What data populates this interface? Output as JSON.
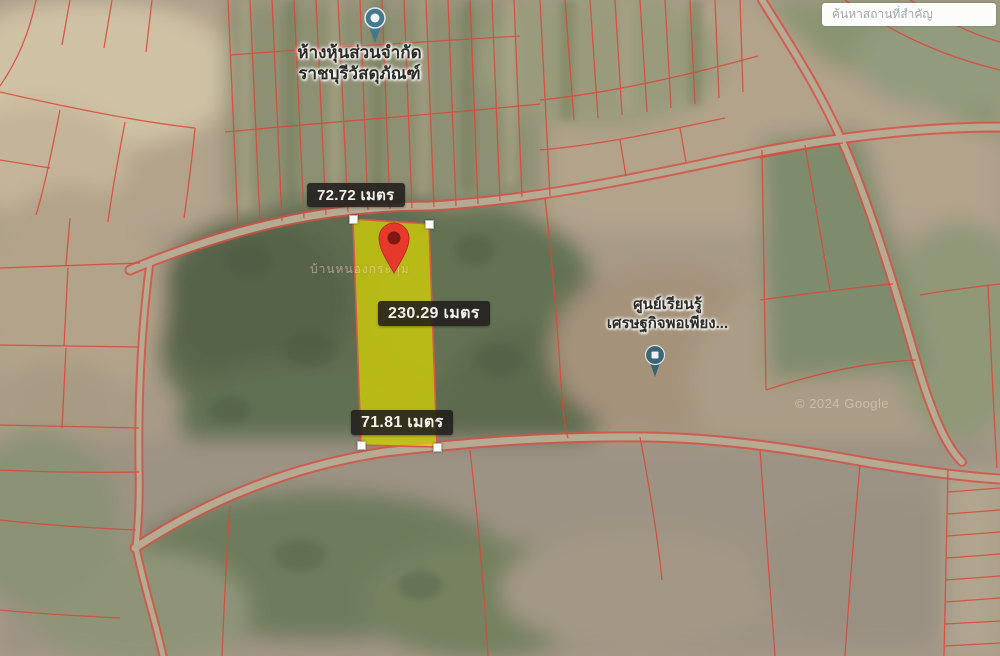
{
  "search": {
    "placeholder": "ค้นหาสถานที่สำคัญ"
  },
  "measurements": {
    "top_width": "72.72 เมตร",
    "length": "230.29 เมตร",
    "bottom_width": "71.81 เมตร"
  },
  "pois": {
    "company": {
      "name_line1": "ห้างหุ้นส่วนจำกัด",
      "name_line2": "ราชบุรีวัสดุภัณฑ์"
    },
    "learning_center": {
      "name_line1": "ศูนย์เรียนรู้",
      "name_line2": "เศรษฐกิจพอเพียง..."
    }
  },
  "area_label": "บ้านหนองกระทุ่ม",
  "watermark": "© 2024 Google",
  "icons": {
    "selected_pin": "red-map-pin",
    "company_pin": "teal-poi-pin",
    "learning_pin": "teal-poi-pin"
  },
  "colors": {
    "parcel_fill": "#d8d500",
    "parcel_border": "#e0574a",
    "boundary_line": "#dc4639",
    "road": "#b5aa92",
    "selected_pin": "#e6392b",
    "label_bg": "#211e1c",
    "label_text": "#f3f0ea"
  }
}
